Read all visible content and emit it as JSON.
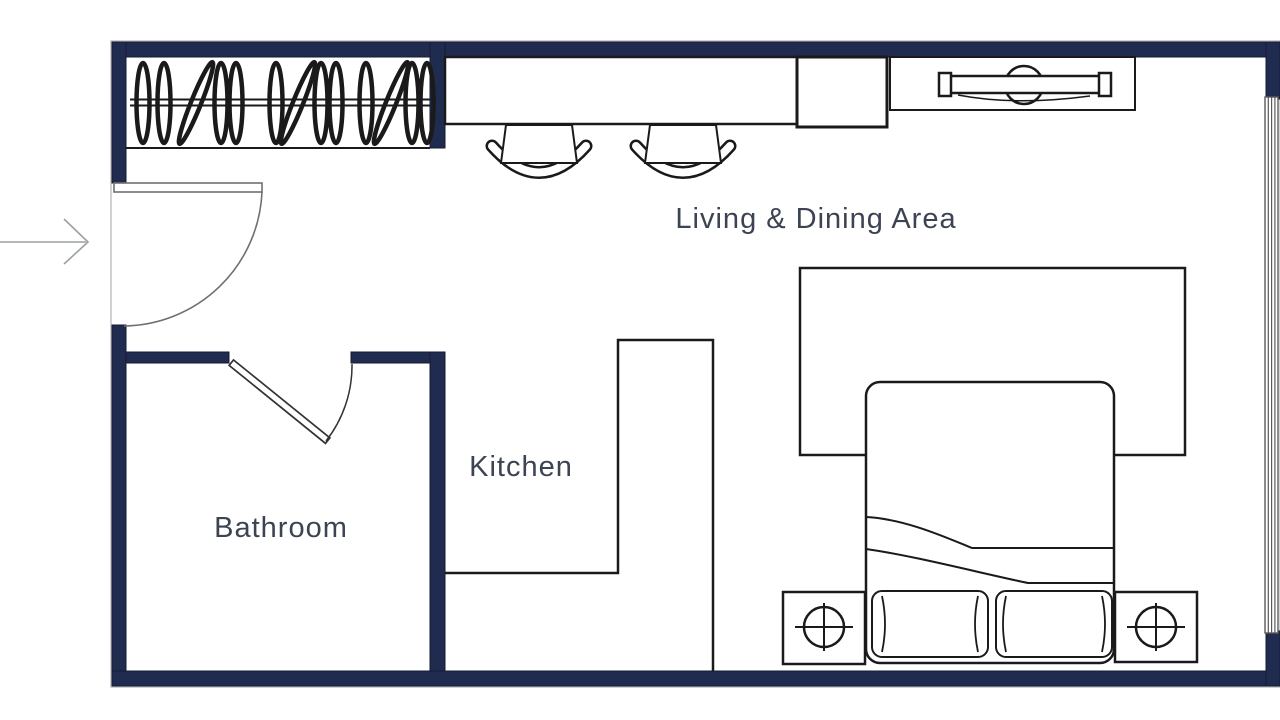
{
  "labels": {
    "living_dining": "Living & Dining Area",
    "kitchen": "Kitchen",
    "bathroom": "Bathroom"
  },
  "colors": {
    "wall": "#1f2c50",
    "line": "#1a1a1a",
    "label_text": "#3c4454",
    "window_line": "#5a5a5a",
    "door_line": "#6f6f6f",
    "arrow": "#9aa0a3",
    "background": "#ffffff"
  },
  "rooms": [
    {
      "id": "living-dining-area",
      "label": "Living & Dining Area"
    },
    {
      "id": "kitchen",
      "label": "Kitchen"
    },
    {
      "id": "bathroom",
      "label": "Bathroom"
    }
  ],
  "furniture": {
    "closet": "wardrobe-rail-with-hangers",
    "hanger_count": 13,
    "breakfast_bar": "counter-along-top-wall",
    "stools": 2,
    "cabinet": "square-appliance",
    "tv_console": "media-console-with-tv",
    "rug": "area-rug",
    "bed": "double-bed-with-duvet",
    "pillows": 2,
    "nightstands": 2,
    "lamps": 2,
    "kitchen_counter": "l-shaped-counter"
  },
  "features": {
    "entry": "entry-door-swing-with-arrow",
    "bathroom_door": "hinged-door-swing",
    "window": "glazed-window-right-wall"
  }
}
